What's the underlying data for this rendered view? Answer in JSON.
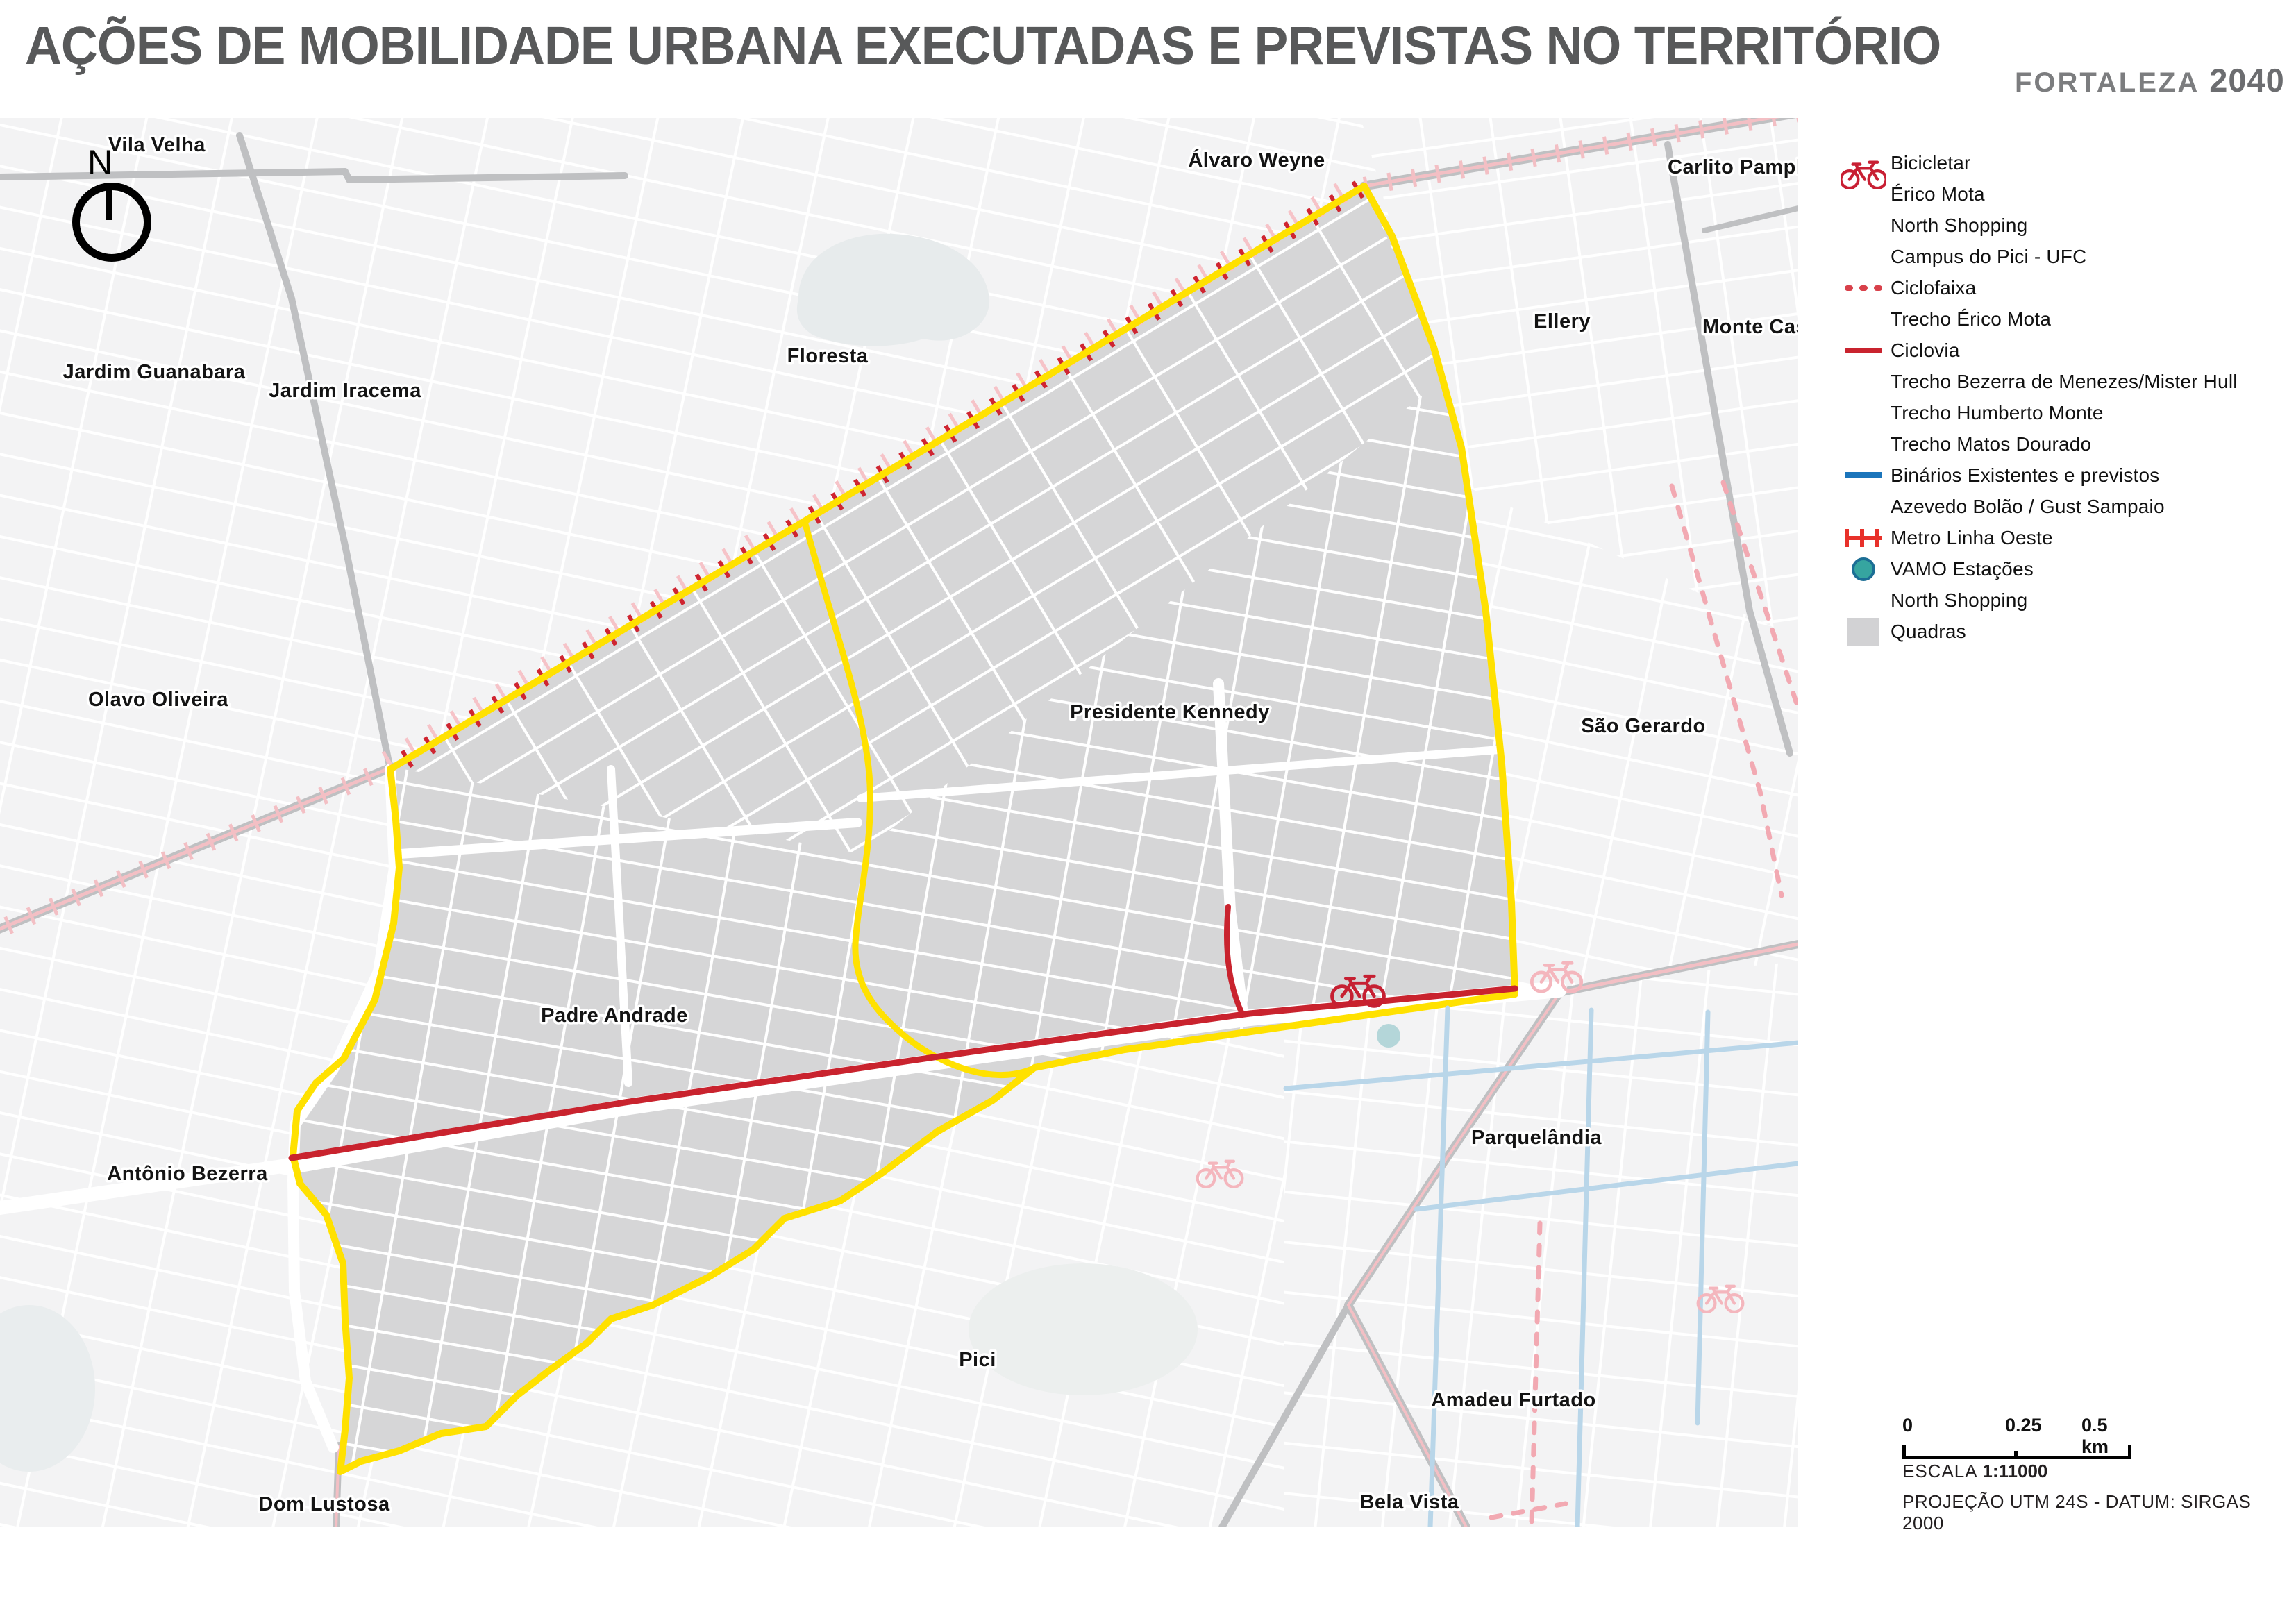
{
  "title": "AÇÕES DE MOBILIDADE URBANA EXECUTADAS E PREVISTAS NO TERRITÓRIO",
  "logo": {
    "city": "FORTALEZA",
    "year": "2040"
  },
  "map": {
    "north_label": "N",
    "labels": [
      {
        "name": "Vila Velha"
      },
      {
        "name": "Jardim Guanabara"
      },
      {
        "name": "Jardim Iracema"
      },
      {
        "name": "Floresta"
      },
      {
        "name": "Álvaro Weyne"
      },
      {
        "name": "Carlito Pamplona"
      },
      {
        "name": "Ellery"
      },
      {
        "name": "Monte Castelo"
      },
      {
        "name": "Olavo Oliveira"
      },
      {
        "name": "Presidente Kennedy"
      },
      {
        "name": "São Gerardo"
      },
      {
        "name": "Padre Andrade"
      },
      {
        "name": "Antônio Bezerra"
      },
      {
        "name": "Parquelândia"
      },
      {
        "name": "Pici"
      },
      {
        "name": "Amadeu Furtado"
      },
      {
        "name": "Bela Vista"
      },
      {
        "name": "Dom Lustosa"
      }
    ]
  },
  "legend": {
    "items": [
      {
        "swatch": "bicicletar-icon",
        "label": "Bicicletar"
      },
      {
        "swatch": "none",
        "label": "Érico Mota"
      },
      {
        "swatch": "none",
        "label": "North Shopping"
      },
      {
        "swatch": "none",
        "label": "Campus do Pici - UFC"
      },
      {
        "swatch": "ciclofaixa-dashed-line",
        "label": "Ciclofaixa"
      },
      {
        "swatch": "none",
        "label": "Trecho Érico Mota"
      },
      {
        "swatch": "ciclovia-solid-line",
        "label": "Ciclovia"
      },
      {
        "swatch": "none",
        "label": "Trecho Bezerra de Menezes/Mister Hull"
      },
      {
        "swatch": "none",
        "label": "Trecho Humberto Monte"
      },
      {
        "swatch": "none",
        "label": "Trecho Matos Dourado"
      },
      {
        "swatch": "binarios-blue-line",
        "label": "Binários Existentes e previstos"
      },
      {
        "swatch": "none",
        "label": "Azevedo Bolão / Gust Sampaio"
      },
      {
        "swatch": "metro-ticked-line",
        "label": "Metro Linha Oeste"
      },
      {
        "swatch": "vamo-circle",
        "label": "VAMO Estações"
      },
      {
        "swatch": "none",
        "label": "North Shopping"
      },
      {
        "swatch": "quadras-square",
        "label": "Quadras"
      }
    ]
  },
  "scale_bar": {
    "tick_labels": [
      "0",
      "0.25",
      "0.5 km"
    ],
    "escala_label": "ESCALA",
    "escala_value": "1:11000",
    "projection": "PROJEÇÃO UTM 24S - DATUM: SIRGAS 2000"
  },
  "colors": {
    "territory_boundary": "#FFE100",
    "ciclovia_red": "#C9232E",
    "ciclofaixa_pink": "#F2A9B2",
    "metro_red": "#E8312A",
    "binarios_blue": "#1B75BB",
    "vamo_teal": "#36A5A0",
    "quadras_gray": "#D6D6D7"
  }
}
